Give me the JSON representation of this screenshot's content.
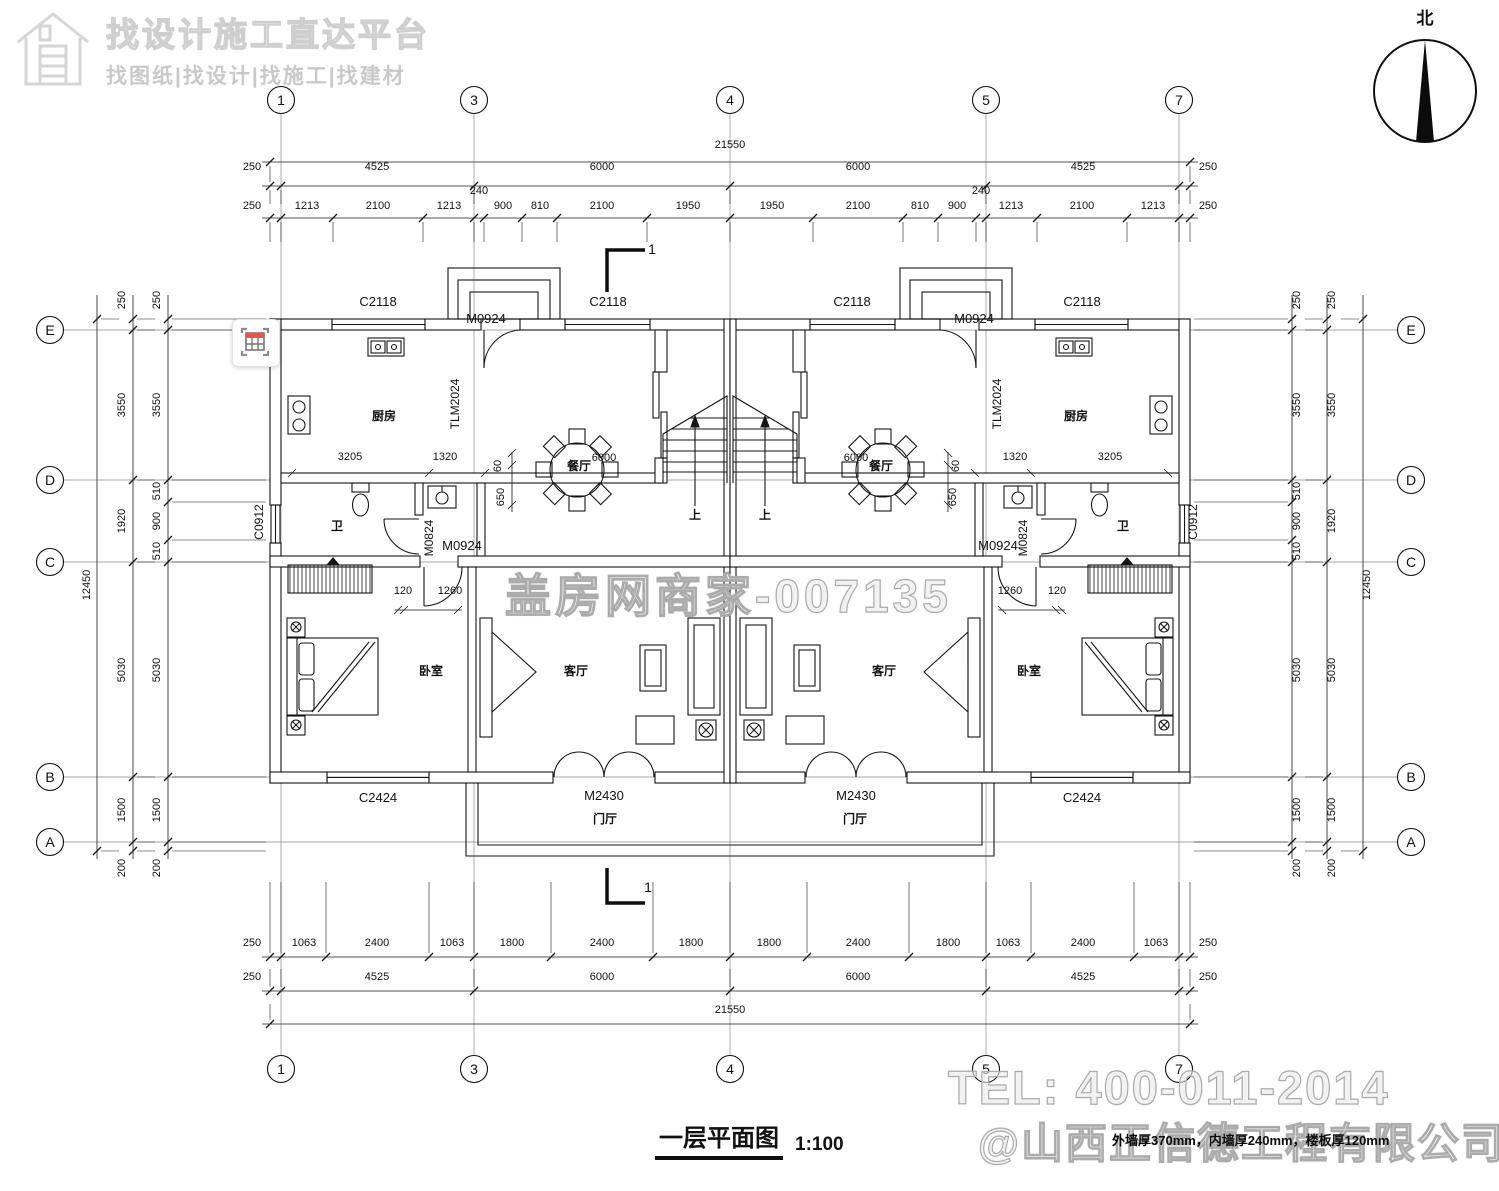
{
  "header": {
    "brand_title": "找设计施工直达平台",
    "brand_subtitle": "找图纸|找设计|找施工|找建材"
  },
  "compass": {
    "label": "北"
  },
  "tool_icon": {
    "name": "table-capture-icon",
    "accent_color": "#e2574b"
  },
  "title_block": {
    "title": "一层平面图",
    "scale": "1:100"
  },
  "watermarks": {
    "center": "盖房网商家-007135",
    "tel": "TEL: 400-011-2014",
    "company": "@山西正信德工程有限公司",
    "note": "外墙厚370mm，内墙厚240mm，楼板厚120mm"
  },
  "colors": {
    "line": "#151515",
    "grid": "#8a8a8a",
    "watermark": "#ababab"
  },
  "axes": {
    "top": {
      "y": 100,
      "items": [
        {
          "label": "1",
          "x": 281
        },
        {
          "label": "3",
          "x": 474
        },
        {
          "label": "4",
          "x": 730
        },
        {
          "label": "5",
          "x": 986
        },
        {
          "label": "7",
          "x": 1179
        }
      ]
    },
    "bottom": {
      "y": 1069,
      "items": [
        {
          "label": "1",
          "x": 281
        },
        {
          "label": "3",
          "x": 474
        },
        {
          "label": "4",
          "x": 730
        },
        {
          "label": "5",
          "x": 986
        },
        {
          "label": "7",
          "x": 1179
        }
      ]
    },
    "left": {
      "x": 50,
      "items": [
        {
          "label": "E",
          "y": 330
        },
        {
          "label": "D",
          "y": 480
        },
        {
          "label": "C",
          "y": 562
        },
        {
          "label": "B",
          "y": 777
        },
        {
          "label": "A",
          "y": 842
        }
      ]
    },
    "right": {
      "x": 1411,
      "items": [
        {
          "label": "E",
          "y": 330
        },
        {
          "label": "D",
          "y": 480
        },
        {
          "label": "C",
          "y": 562
        },
        {
          "label": "B",
          "y": 777
        },
        {
          "label": "A",
          "y": 842
        }
      ]
    }
  },
  "labels": [
    [
      "21550",
      730,
      148
    ],
    [
      "250",
      252,
      170
    ],
    [
      "4525",
      377,
      170
    ],
    [
      "6000",
      602,
      170
    ],
    [
      "6000",
      858,
      170
    ],
    [
      "4525",
      1083,
      170
    ],
    [
      "250",
      1208,
      170
    ],
    [
      "250",
      252,
      209
    ],
    [
      "1213",
      307,
      209
    ],
    [
      "2100",
      378,
      209
    ],
    [
      "1213",
      449,
      209
    ],
    [
      "240",
      479,
      194
    ],
    [
      "900",
      503,
      209
    ],
    [
      "810",
      540,
      209
    ],
    [
      "2100",
      602,
      209
    ],
    [
      "1950",
      688,
      209
    ],
    [
      "1950",
      772,
      209
    ],
    [
      "2100",
      858,
      209
    ],
    [
      "810",
      920,
      209
    ],
    [
      "900",
      957,
      209
    ],
    [
      "240",
      981,
      194
    ],
    [
      "1213",
      1011,
      209
    ],
    [
      "2100",
      1082,
      209
    ],
    [
      "1213",
      1153,
      209
    ],
    [
      "250",
      1208,
      209
    ],
    [
      "250",
      252,
      946
    ],
    [
      "1063",
      304,
      946
    ],
    [
      "2400",
      377,
      946
    ],
    [
      "1063",
      452,
      946
    ],
    [
      "1800",
      512,
      946
    ],
    [
      "2400",
      602,
      946
    ],
    [
      "1800",
      691,
      946
    ],
    [
      "1800",
      769,
      946
    ],
    [
      "2400",
      858,
      946
    ],
    [
      "1800",
      948,
      946
    ],
    [
      "1063",
      1008,
      946
    ],
    [
      "2400",
      1083,
      946
    ],
    [
      "1063",
      1156,
      946
    ],
    [
      "250",
      1208,
      946
    ],
    [
      "250",
      252,
      980
    ],
    [
      "4525",
      377,
      980
    ],
    [
      "6000",
      602,
      980
    ],
    [
      "6000",
      858,
      980
    ],
    [
      "4525",
      1083,
      980
    ],
    [
      "250",
      1208,
      980
    ],
    [
      "21550",
      730,
      1013
    ],
    [
      "250",
      160,
      300,
      -90
    ],
    [
      "3550",
      160,
      405,
      -90
    ],
    [
      "510",
      160,
      491,
      -90
    ],
    [
      "900",
      160,
      521,
      -90
    ],
    [
      "510",
      160,
      551,
      -90
    ],
    [
      "5030",
      160,
      670,
      -90
    ],
    [
      "1500",
      160,
      810,
      -90
    ],
    [
      "200",
      160,
      868,
      -90
    ],
    [
      "250",
      125,
      300,
      -90
    ],
    [
      "3550",
      125,
      405,
      -90
    ],
    [
      "1920",
      125,
      521,
      -90
    ],
    [
      "5030",
      125,
      670,
      -90
    ],
    [
      "1500",
      125,
      810,
      -90
    ],
    [
      "200",
      125,
      868,
      -90
    ],
    [
      "12450",
      90,
      585,
      -90
    ],
    [
      "250",
      1300,
      300,
      -90
    ],
    [
      "3550",
      1300,
      405,
      -90
    ],
    [
      "510",
      1300,
      491,
      -90
    ],
    [
      "900",
      1300,
      521,
      -90
    ],
    [
      "510",
      1300,
      551,
      -90
    ],
    [
      "5030",
      1300,
      670,
      -90
    ],
    [
      "1500",
      1300,
      810,
      -90
    ],
    [
      "200",
      1300,
      868,
      -90
    ],
    [
      "250",
      1335,
      300,
      -90
    ],
    [
      "3550",
      1335,
      405,
      -90
    ],
    [
      "1920",
      1335,
      521,
      -90
    ],
    [
      "5030",
      1335,
      670,
      -90
    ],
    [
      "1500",
      1335,
      810,
      -90
    ],
    [
      "200",
      1335,
      868,
      -90
    ],
    [
      "12450",
      1370,
      585,
      -90
    ],
    [
      "C2118",
      378,
      306,
      0,
      13
    ],
    [
      "C2118",
      608,
      306,
      0,
      13
    ],
    [
      "C2118",
      852,
      306,
      0,
      13
    ],
    [
      "C2118",
      1082,
      306,
      0,
      13
    ],
    [
      "M0924",
      486,
      323,
      0,
      13
    ],
    [
      "M0924",
      974,
      323,
      0,
      13
    ],
    [
      "TLM2024",
      459,
      404,
      -90,
      12
    ],
    [
      "TLM2024",
      1001,
      404,
      -90,
      12
    ],
    [
      "C0912",
      263,
      522,
      -90,
      12
    ],
    [
      "C0912",
      1197,
      522,
      -90,
      12
    ],
    [
      "M0824",
      433,
      538,
      -90,
      12
    ],
    [
      "M0824",
      1027,
      538,
      -90,
      12
    ],
    [
      "M0924",
      462,
      550,
      0,
      13
    ],
    [
      "M0924",
      998,
      550,
      0,
      13
    ],
    [
      "C2424",
      378,
      802,
      0,
      13
    ],
    [
      "C2424",
      1082,
      802,
      0,
      13
    ],
    [
      "M2430",
      604,
      800,
      0,
      13
    ],
    [
      "M2430",
      856,
      800,
      0,
      13
    ],
    [
      "厨房",
      384,
      420,
      0,
      12,
      "room"
    ],
    [
      "厨房",
      1076,
      420,
      0,
      12,
      "room"
    ],
    [
      "餐厅",
      579,
      470,
      0,
      12,
      "room"
    ],
    [
      "餐厅",
      881,
      470,
      0,
      12,
      "room"
    ],
    [
      "卫",
      337,
      530,
      0,
      12,
      "room"
    ],
    [
      "卫",
      1123,
      530,
      0,
      12,
      "room"
    ],
    [
      "卧室",
      431,
      675,
      0,
      12,
      "room"
    ],
    [
      "卧室",
      1029,
      675,
      0,
      12,
      "room"
    ],
    [
      "客厅",
      576,
      675,
      0,
      12,
      "room"
    ],
    [
      "客厅",
      884,
      675,
      0,
      12,
      "room"
    ],
    [
      "门厅",
      605,
      823,
      0,
      12,
      "room"
    ],
    [
      "门厅",
      855,
      823,
      0,
      12,
      "room"
    ],
    [
      "上",
      695,
      519,
      0,
      12,
      "room"
    ],
    [
      "上",
      765,
      519,
      0,
      12,
      "room"
    ],
    [
      "3205",
      350,
      460
    ],
    [
      "1320",
      445,
      460
    ],
    [
      "1320",
      1015,
      460
    ],
    [
      "3205",
      1110,
      460
    ],
    [
      "6000",
      604,
      461
    ],
    [
      "6000",
      856,
      461
    ],
    [
      "60",
      501,
      466,
      -90
    ],
    [
      "650",
      504,
      497,
      -90
    ],
    [
      "60",
      959,
      466,
      -90
    ],
    [
      "650",
      956,
      497,
      -90
    ],
    [
      "120",
      403,
      594
    ],
    [
      "1260",
      450,
      594
    ],
    [
      "1260",
      1010,
      594
    ],
    [
      "120",
      1057,
      594
    ],
    [
      "1",
      652,
      254,
      0,
      14
    ],
    [
      "1",
      648,
      892,
      0,
      14
    ]
  ]
}
